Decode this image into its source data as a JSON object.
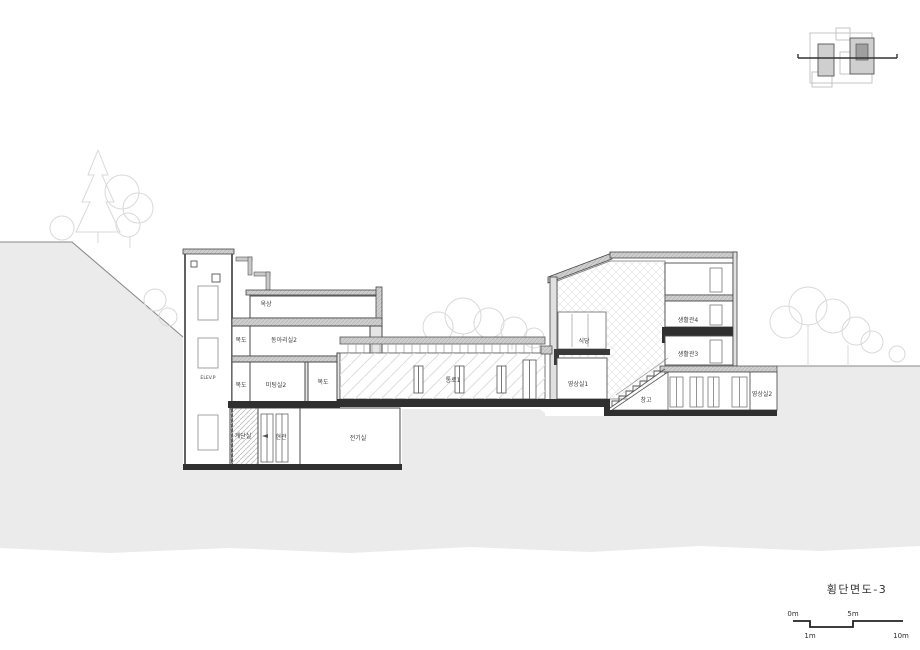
{
  "drawing": {
    "title": "횡단면도-3",
    "scale_bar": {
      "m0": "0m",
      "m5": "5m",
      "m1": "1m",
      "m10": "10m"
    },
    "labels": {
      "elevator_pit": "ELEV.P",
      "rooftop": "옥상",
      "corridor_upper": "복도",
      "club_room2": "동아리실2",
      "corridor_lower_left": "복도",
      "meeting_room2": "미팅실2",
      "corridor_lower_right": "복도",
      "stair_room": "계단실",
      "entrance": "현관",
      "electrical_room": "전기실",
      "passage1": "통로1",
      "dining": "식당",
      "av_room1": "영상실1",
      "storage": "창고",
      "av_room2": "영상실2",
      "dorm_room4": "생활관4",
      "dorm_room3": "생활관3"
    },
    "colors": {
      "ground": "#ebebeb",
      "slab_dark": "#2f2f2f",
      "slab_light": "#c9c9c9",
      "line": "#444444",
      "tree": "#d9d9d9"
    }
  }
}
